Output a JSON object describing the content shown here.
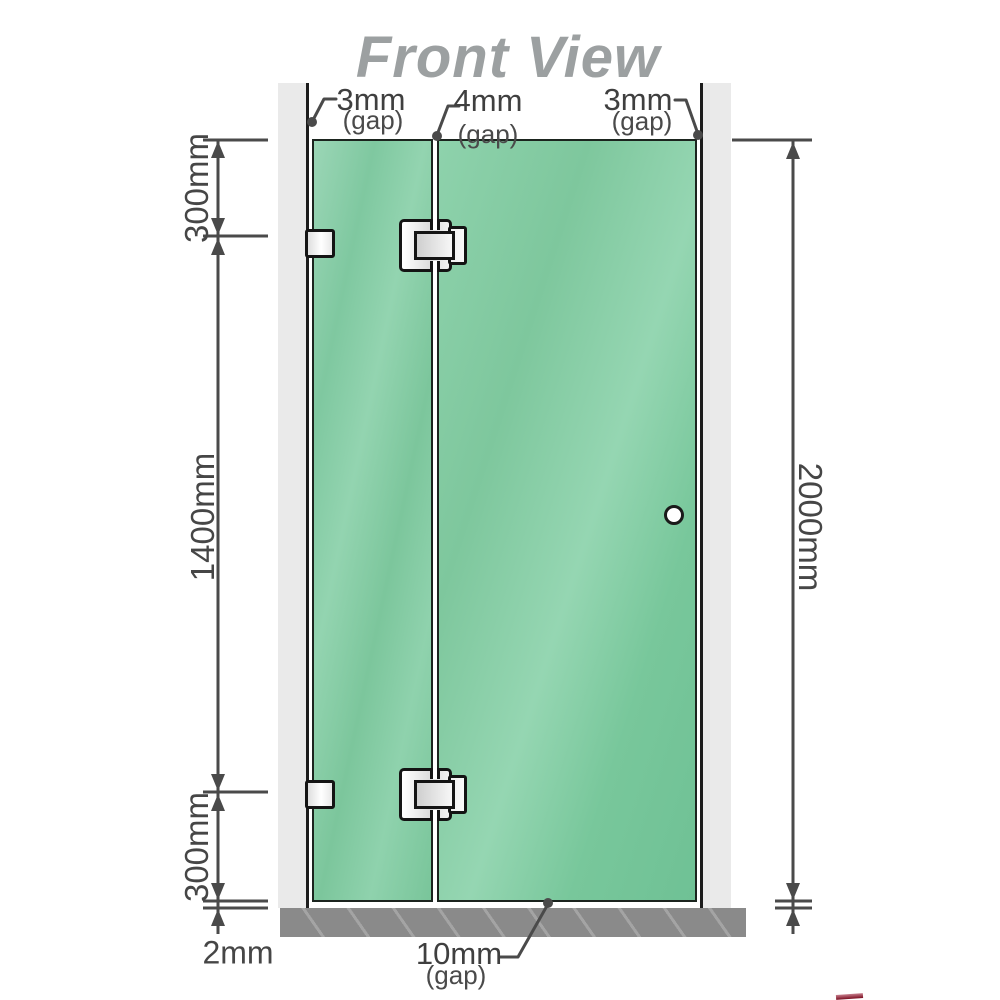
{
  "title": "Front View",
  "gaps": {
    "left": {
      "value": "3mm",
      "note": "(gap)"
    },
    "middle": {
      "value": "4mm",
      "note": "(gap)"
    },
    "right": {
      "value": "3mm",
      "note": "(gap)"
    },
    "bottom": {
      "value": "10mm",
      "note": "(gap)"
    }
  },
  "dimensions": {
    "left_top": "300mm",
    "left_middle": "1400mm",
    "left_bottom": "300mm",
    "base_gap": "2mm",
    "right_total": "2000mm"
  },
  "colors": {
    "glass": "#82ca9f",
    "glass_highlight": "#9ad9b8",
    "wall": "#eaeaea",
    "base": "#8a8a8a",
    "dimension_line": "#4a4a4a",
    "title_text": "#9ca0a1",
    "hardware": "#e8e8e8"
  }
}
